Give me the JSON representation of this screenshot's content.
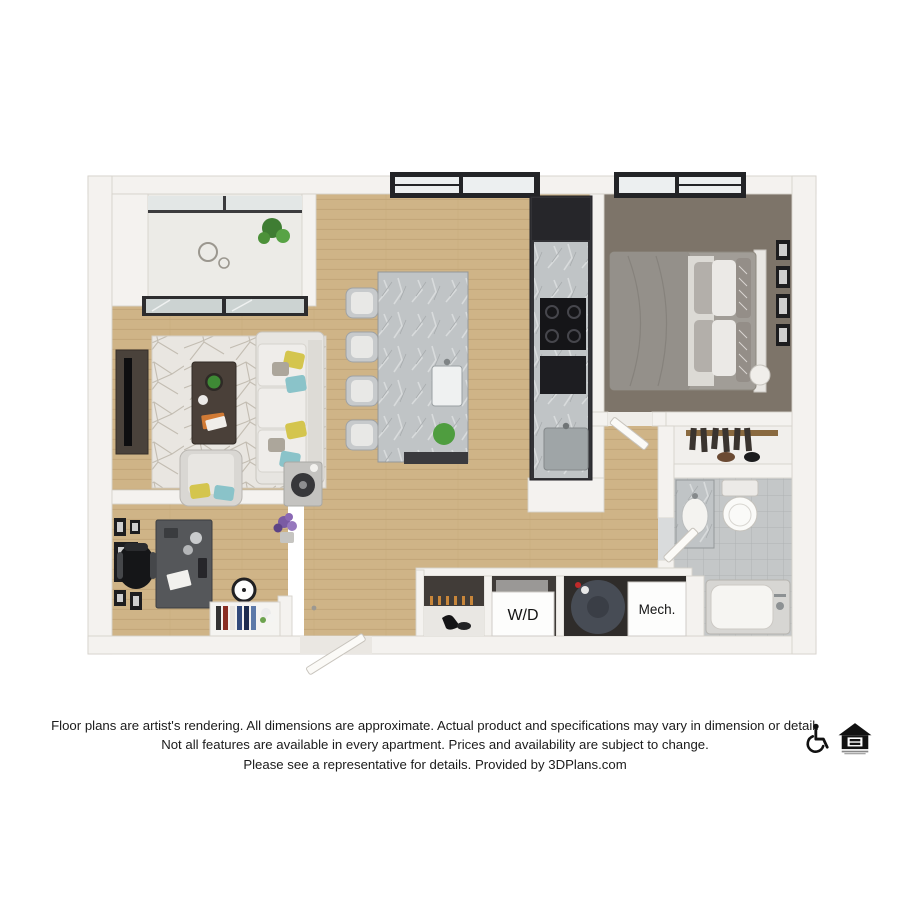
{
  "plan": {
    "type": "apartment-floor-plan-3d-render",
    "closet_labels": {
      "washer_dryer": "W/D",
      "mechanical": "Mech."
    },
    "rooms_depicted": [
      "balcony",
      "living-room",
      "office-den",
      "kitchen-dining",
      "bedroom",
      "closet",
      "bathroom",
      "entry",
      "laundry-closet",
      "mechanical-closet"
    ],
    "colors": {
      "wall": "#f4f2ef",
      "wall_edge": "#d6d2cb",
      "wood_floor": "#cfb487",
      "plank_line": "#b6996c",
      "carpet": "#7d7469",
      "tile": "#c4c7c8",
      "marble_counter": "#c0c4c6",
      "cabinet_dark": "#323236",
      "sofa_white": "#e7e5e1",
      "accent_yellow": "#d4c54e",
      "accent_teal": "#8ac3c9",
      "plant_green": "#4f9d3f",
      "flower_purple": "#8a68b4"
    }
  },
  "disclaimer": {
    "line1": "Floor plans are artist's rendering. All dimensions are approximate. Actual product and specifications may vary in dimension or detail.",
    "line2": "Not all features are available in every apartment. Prices and availability are subject to change.",
    "line3": "Please see a representative for details. Provided by 3DPlans.com"
  },
  "footer_icons": {
    "accessibility": "wheelchair-accessible-icon",
    "fair_housing": "equal-housing-opportunity-icon"
  },
  "text_color": "#1b1b1b"
}
